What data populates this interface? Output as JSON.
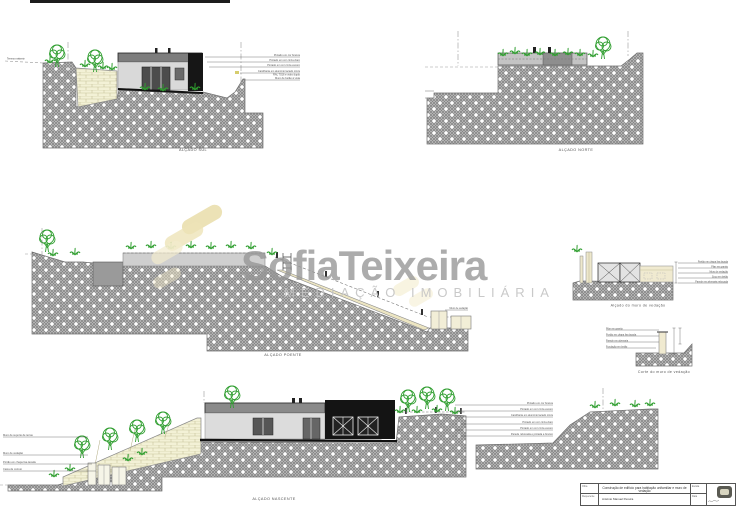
{
  "watermark": {
    "brand": "SofiaTeixeira",
    "tagline": "MEDIAÇÃO IMOBILIÁRIA",
    "pill_color": "#EADFAE",
    "brand_color": "#969696"
  },
  "views": {
    "sul": {
      "label": "ALÇADO SUL",
      "terrain_note": "Terreno existente",
      "annotations": [
        "Pintado em cor branca",
        "Pintado em cor cinza claro",
        "Pintado em cor cinza escuro",
        "Caixilharia em alumínio lacado cinza",
        "RAL 7016 e vidro duplo",
        "Muro de betão à vista"
      ]
    },
    "norte": {
      "label": "ALÇADO NORTE"
    },
    "poente": {
      "label": "ALÇADO POENTE",
      "annotations": [
        "Muro de vedação"
      ]
    },
    "nascente": {
      "label": "ALÇADO NASCENTE",
      "annotations_right": [
        "Pintado em cor branca",
        "Pintado em cor cinza escuro",
        "Caixilharia em alumínio lacado cinza",
        "Pintado em cor cinza claro",
        "Pintado em cor cinza escuro",
        "Parede rebocada e pintada a branco"
      ],
      "annotations_left": [
        "Muro de suporte de terras",
        "Muro de vedação",
        "Portão em chapa lisa lacada",
        "Caixa de correio"
      ]
    },
    "muro_alcado": {
      "label": "Alçado do muro de vedação",
      "annotations": [
        "Portão em chapa lisa lacada",
        "Pilar em granito",
        "Muro de vedação",
        "Soco em betão",
        "Parede em alvenaria rebocada"
      ]
    },
    "muro_corte": {
      "label": "Corte do muro de vedação",
      "annotations": [
        "Pilar em granito",
        "Portão em chapa lisa lacada",
        "Parede em alvenaria",
        "Fundação em betão"
      ]
    }
  },
  "title_block": {
    "obra_label": "Obra",
    "obra": "Construção de edifício para habitação unifamiliar e muro de vedação",
    "requerente_label": "Requerente",
    "requerente": "António Manuel Pereira",
    "escala_label": "Escala",
    "data_label": "Data"
  },
  "colors": {
    "hatch_gray": "#c9c9c9",
    "brick_cream": "#f3f1d6",
    "plant_green": "#2f9e2f"
  }
}
